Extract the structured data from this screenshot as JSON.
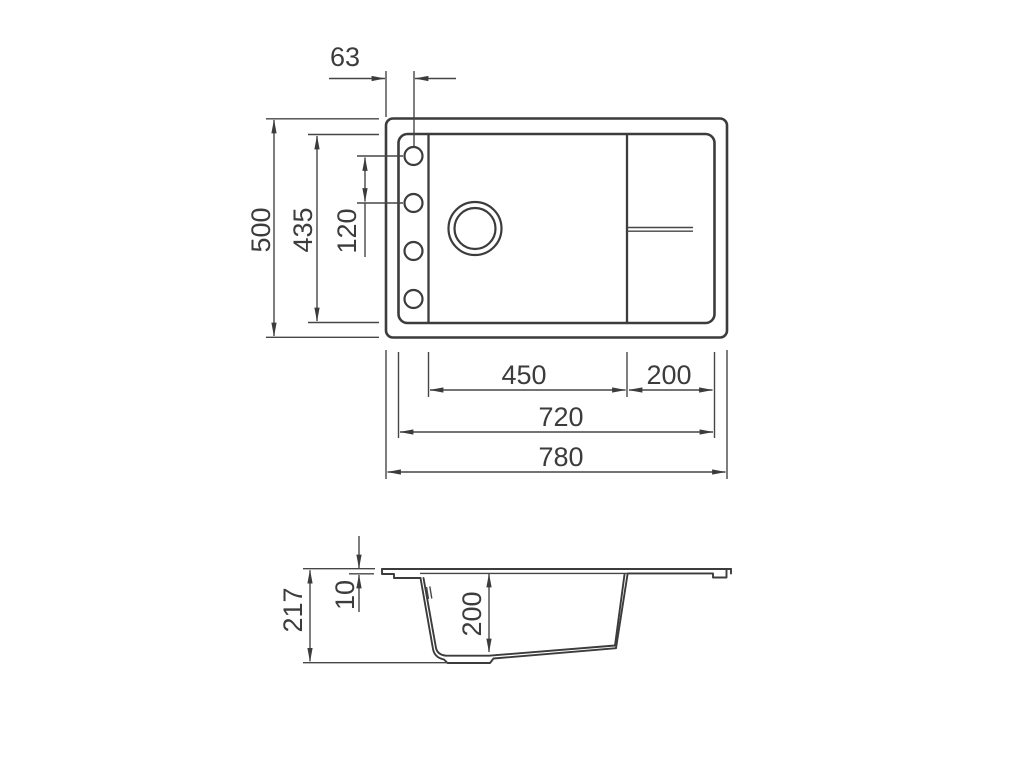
{
  "document": {
    "type": "technical-drawing",
    "subject": "Kitchen sink dimensional drawing (plan view and cross-section)",
    "background_color": "#ffffff",
    "line_color": "#3c3c3c",
    "text_color": "#3c3c3c",
    "units": "mm"
  },
  "top_view": {
    "label": "plan-view-of-sink",
    "features": [
      "outer-rim-rectangle",
      "inner-basin-rectangle",
      "faucet-deck-strip-with-4-holes",
      "main-bowl-with-drain-hole",
      "drainboard-section-with-drip-channel"
    ],
    "dims": {
      "faucet_hole_offset": "63",
      "overall_depth": "500",
      "inner_depth": "435",
      "faucet_hole_pitch": "120",
      "bowl_width": "450",
      "drainboard_width": "200",
      "inner_width": "720",
      "overall_width": "780"
    }
  },
  "section_view": {
    "label": "cross-section-of-sink",
    "features": [
      "rim-profile",
      "bowl-cavity",
      "drain-recess",
      "sloped-underside",
      "ground-reference-line"
    ],
    "dims": {
      "overall_height": "217",
      "rim_height": "10",
      "bowl_depth": "200"
    }
  }
}
